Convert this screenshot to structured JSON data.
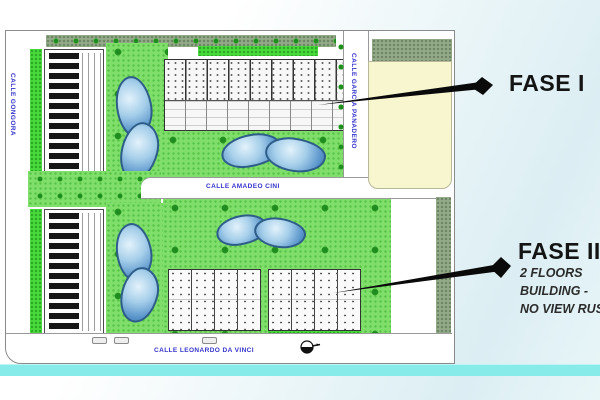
{
  "plan": {
    "streets": {
      "left": "CALLE GONGORA",
      "right": "CALLE GARCIA PANADERO",
      "middle": "CALLE AMADEO CINI",
      "bottom": "CALLE LEONARDO DA VINCI"
    },
    "street_label_color": "#3434cc"
  },
  "annotations": {
    "fase1": {
      "label": "FASE I"
    },
    "fase2": {
      "label": "FASE II",
      "notes": [
        "2 FLOORS",
        "BUILDING -",
        "NO VIEW RUSH"
      ]
    },
    "arrow_color": "#0a0a0a"
  },
  "colors": {
    "lawn": "#7fdf6a",
    "lawn_bright": "#49d93c",
    "hedge": "#93aa88",
    "pool_deep": "#3c7ab5",
    "pool_light": "#e3f2fb",
    "parcel_yellow": "#f8f6cf",
    "cyan_strip": "#86ebe9"
  },
  "icons": {
    "compass": "compass-north-icon"
  }
}
